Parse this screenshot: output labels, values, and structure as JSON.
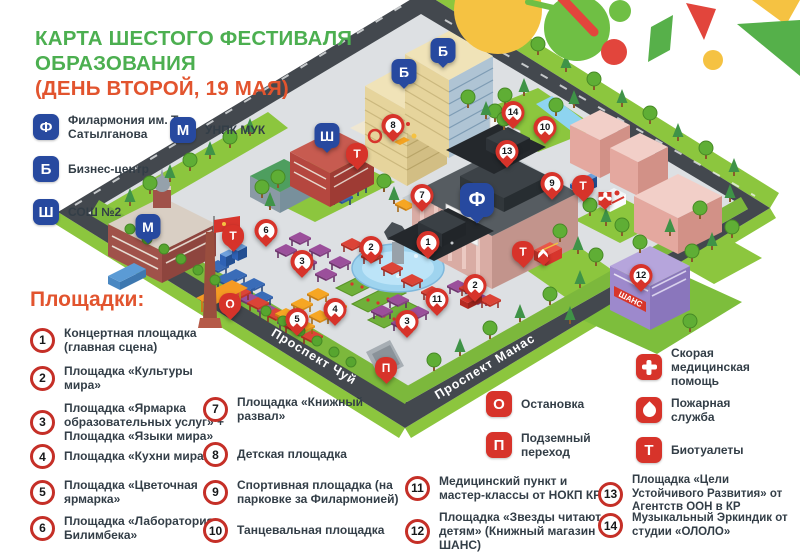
{
  "title": {
    "green": "КАРТА ШЕСТОГО ФЕСТИВАЛЯ ОБРАЗОВАНИЯ",
    "orange": "(ДЕНЬ ВТОРОЙ, 19 МАЯ)"
  },
  "colors": {
    "title_green": "#4CAF50",
    "accent_orange": "#E2542E",
    "legend_blue": "#27499F",
    "legend_red": "#D7332A"
  },
  "building_legend": [
    {
      "letter": "Ф",
      "label": "Филармония им. Т. Сатылганова"
    },
    {
      "letter": "М",
      "label": "УНПК МУК"
    },
    {
      "letter": "Б",
      "label": "Бизнес-центр"
    },
    {
      "letter": "Ш",
      "label": "СОШ №2"
    }
  ],
  "venues_heading": "Площадки:",
  "venues": [
    {
      "num": "1",
      "label": "Концертная площадка (главная сцена)"
    },
    {
      "num": "2",
      "label": "Площадка «Культуры мира»"
    },
    {
      "num": "3",
      "label": "Площадка «Ярмарка образовательных услуг» + Площадка «Языки мира»"
    },
    {
      "num": "4",
      "label": "Площадка «Кухни мира»"
    },
    {
      "num": "5",
      "label": "Площадка «Цветочная ярмарка»"
    },
    {
      "num": "6",
      "label": "Площадка «Лаборатория Билимбека»"
    },
    {
      "num": "7",
      "label": "Площадка «Книжный развал»"
    },
    {
      "num": "8",
      "label": "Детская площадка"
    },
    {
      "num": "9",
      "label": "Спортивная площадка (на парковке за Филармонией)"
    },
    {
      "num": "10",
      "label": "Танцевальная площадка"
    },
    {
      "num": "11",
      "label": "Медицинский пункт и мастер-классы от НОКП КР"
    },
    {
      "num": "12",
      "label": "Площадка «Звезды читают детям» (Книжный магазин ШАНС)"
    },
    {
      "num": "13",
      "label": "Площадка «Цели Устойчивого Развития» от Агентств ООН в КР"
    },
    {
      "num": "14",
      "label": "Музыкальный Эркиндик от студии «ОЛОЛО»"
    }
  ],
  "service_legend": [
    {
      "symbol": "О",
      "label": "Остановка"
    },
    {
      "symbol": "П",
      "label": "Подземный переход"
    }
  ],
  "emergency_legend": [
    {
      "icon": "medical-cross",
      "label": "Скорая медицинская помощь"
    },
    {
      "icon": "flame",
      "label": "Пожарная служба"
    },
    {
      "icon": "letter",
      "symbol": "Т",
      "label": "Биотуалеты"
    }
  ],
  "map": {
    "street_chuy": "Проспект Чуй",
    "street_manas": "Проспект Манас",
    "shans_sign": "ШАНС",
    "pins": [
      {
        "label": "Ф",
        "type": "letter-blue",
        "big": true,
        "x": 477,
        "y": 221
      },
      {
        "label": "М",
        "type": "letter-blue",
        "x": 148,
        "y": 242
      },
      {
        "label": "Б",
        "type": "letter-blue",
        "x": 404,
        "y": 87
      },
      {
        "label": "Б",
        "type": "letter-blue",
        "x": 443,
        "y": 66
      },
      {
        "label": "Ш",
        "type": "letter-blue",
        "x": 327,
        "y": 151
      },
      {
        "label": "Т",
        "type": "letter-red",
        "x": 357,
        "y": 168
      },
      {
        "label": "Т",
        "type": "letter-red",
        "x": 233,
        "y": 250
      },
      {
        "label": "Т",
        "type": "letter-red",
        "x": 583,
        "y": 200
      },
      {
        "label": "Т",
        "type": "letter-red",
        "x": 523,
        "y": 266
      },
      {
        "type": "cross",
        "x": 605,
        "y": 208
      },
      {
        "type": "flame",
        "x": 543,
        "y": 264
      },
      {
        "label": "О",
        "type": "letter-red",
        "x": 230,
        "y": 318
      },
      {
        "label": "П",
        "type": "letter-red",
        "x": 386,
        "y": 382
      },
      {
        "label": "1",
        "type": "num",
        "x": 428,
        "y": 257
      },
      {
        "label": "2",
        "type": "num",
        "x": 371,
        "y": 262
      },
      {
        "label": "2",
        "type": "num",
        "x": 475,
        "y": 300
      },
      {
        "label": "3",
        "type": "num",
        "x": 302,
        "y": 276
      },
      {
        "label": "3",
        "type": "num",
        "x": 407,
        "y": 336
      },
      {
        "label": "4",
        "type": "num",
        "x": 335,
        "y": 324
      },
      {
        "label": "5",
        "type": "num",
        "x": 297,
        "y": 334
      },
      {
        "label": "6",
        "type": "num",
        "x": 266,
        "y": 245
      },
      {
        "label": "7",
        "type": "num",
        "x": 422,
        "y": 210
      },
      {
        "label": "8",
        "type": "num",
        "x": 393,
        "y": 140
      },
      {
        "label": "9",
        "type": "num",
        "x": 552,
        "y": 198
      },
      {
        "label": "10",
        "type": "num",
        "x": 545,
        "y": 142
      },
      {
        "label": "11",
        "type": "num",
        "x": 437,
        "y": 314
      },
      {
        "label": "12",
        "type": "num",
        "x": 641,
        "y": 290
      },
      {
        "label": "13",
        "type": "num",
        "x": 507,
        "y": 166
      },
      {
        "label": "14",
        "type": "num",
        "x": 513,
        "y": 127
      }
    ]
  }
}
